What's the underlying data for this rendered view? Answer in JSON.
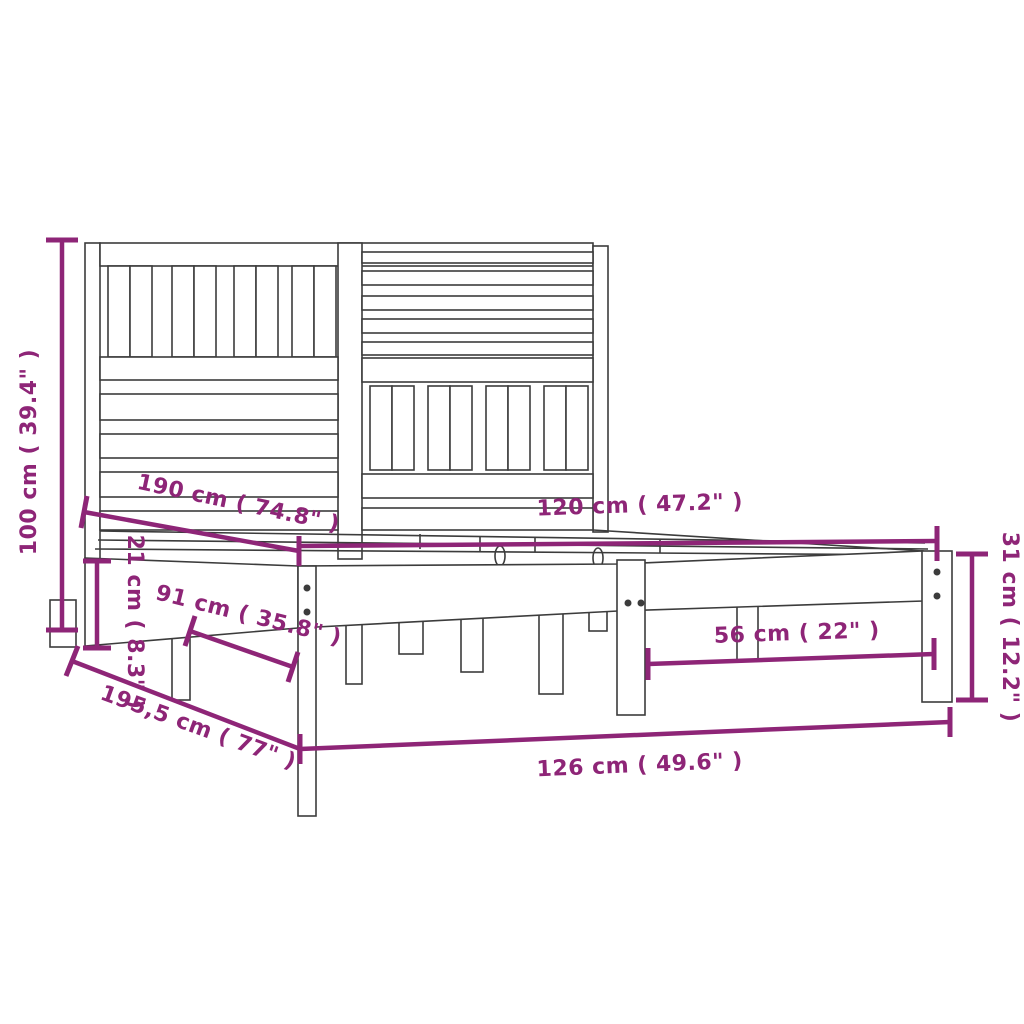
{
  "diagram": {
    "title": "bed-frame-dimension-diagram",
    "product": "wood bed frame with slatted headboard",
    "colors": {
      "dimension": "#8E2577",
      "outline": "#3C3C3C",
      "background": "#FFFFFF"
    },
    "dimensions": {
      "total_height": {
        "label": "100 cm ( 39.4\" )",
        "cm": "100",
        "inch": "39.4"
      },
      "inner_length": {
        "label": "190 cm ( 74.8\" )",
        "cm": "190",
        "inch": "74.8"
      },
      "inner_width": {
        "label": "120 cm ( 47.2\" )",
        "cm": "120",
        "inch": "47.2"
      },
      "rail_height": {
        "label": "21 cm ( 8.3\" )",
        "cm": "21",
        "inch": "8.3"
      },
      "leg_spacing": {
        "label": "91 cm ( 35.8\" )",
        "cm": "91",
        "inch": "35.8"
      },
      "foot_clearance": {
        "label": "56 cm ( 22\" )",
        "cm": "56",
        "inch": "22"
      },
      "base_height": {
        "label": "31 cm ( 12.2\" )",
        "cm": "31",
        "inch": "12.2"
      },
      "outer_length": {
        "label": "195,5 cm ( 77\" )",
        "cm": "195,5",
        "inch": "77"
      },
      "outer_width": {
        "label": "126 cm ( 49.6\" )",
        "cm": "126",
        "inch": "49.6"
      }
    }
  }
}
